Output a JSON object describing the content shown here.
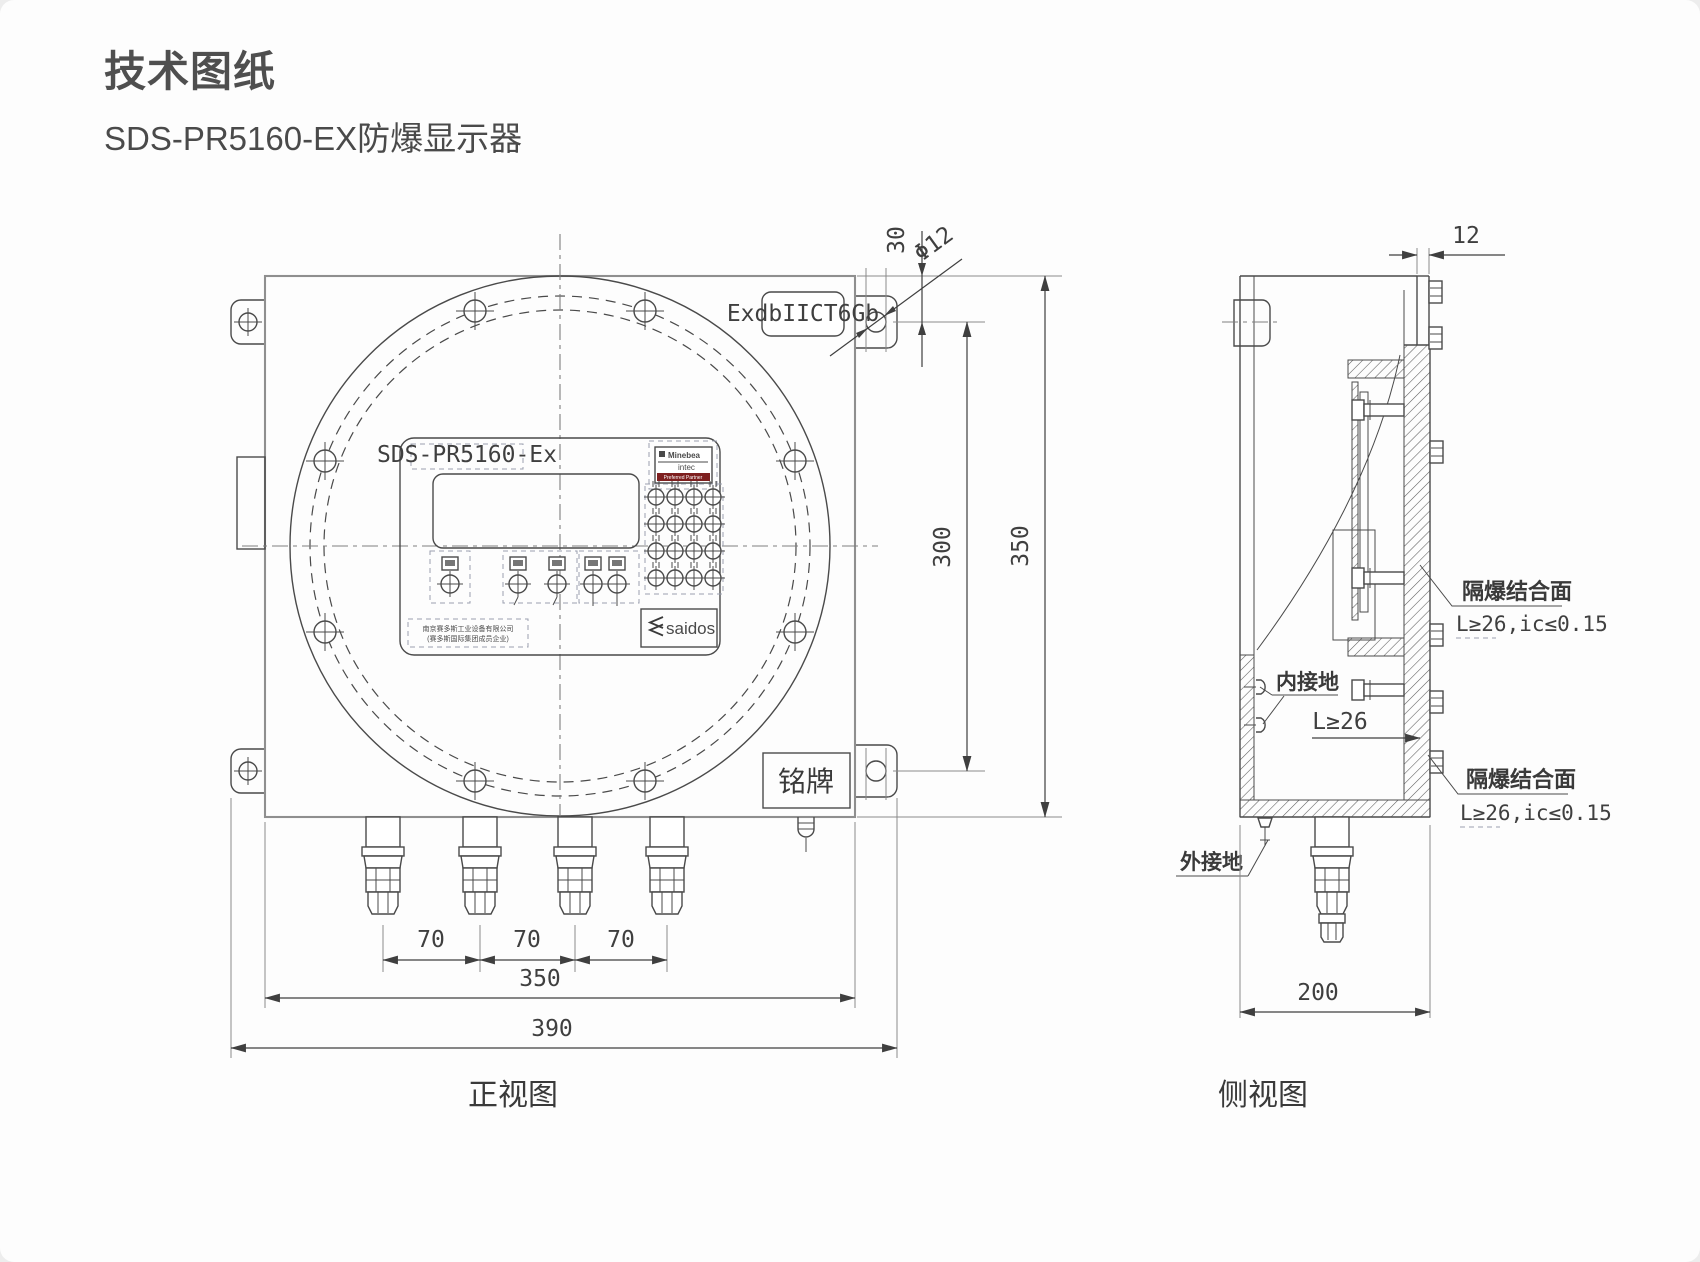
{
  "page": {
    "title": "技术图纸",
    "subtitle": "SDS-PR5160-EX防爆显示器"
  },
  "front_view": {
    "caption": "正视图",
    "cert_label": "ExdbIICT6Gb",
    "nameplate_label": "铭牌",
    "panel": {
      "model_label": "SDS-PR5160-Ex",
      "brand_line1": "Minebea",
      "brand_line2": "intec",
      "brand_banner": "Preferred Partner",
      "company_line1": "南京赛多斯工业设备有限公司",
      "company_line2": "(赛多斯国际集团成员企业)",
      "logo_text": "saidos"
    },
    "dims": {
      "hole_offset": "30",
      "hole_dia": "Φ12",
      "hole_span": "300",
      "height": "350",
      "pitch1": "70",
      "pitch2": "70",
      "pitch3": "70",
      "width": "350",
      "overall_width": "390"
    }
  },
  "side_view": {
    "caption": "侧视图",
    "labels": {
      "inner_ground": "内接地",
      "outer_ground": "外接地",
      "joint_top_title": "隔爆结合面",
      "joint_top_spec": "L≥26,ic≤0.15",
      "joint_bottom_title": "隔爆结合面",
      "joint_bottom_spec": "L≥26,ic≤0.15",
      "joint_length": "L≥26"
    },
    "dims": {
      "cover_thickness": "12",
      "depth": "200"
    }
  }
}
